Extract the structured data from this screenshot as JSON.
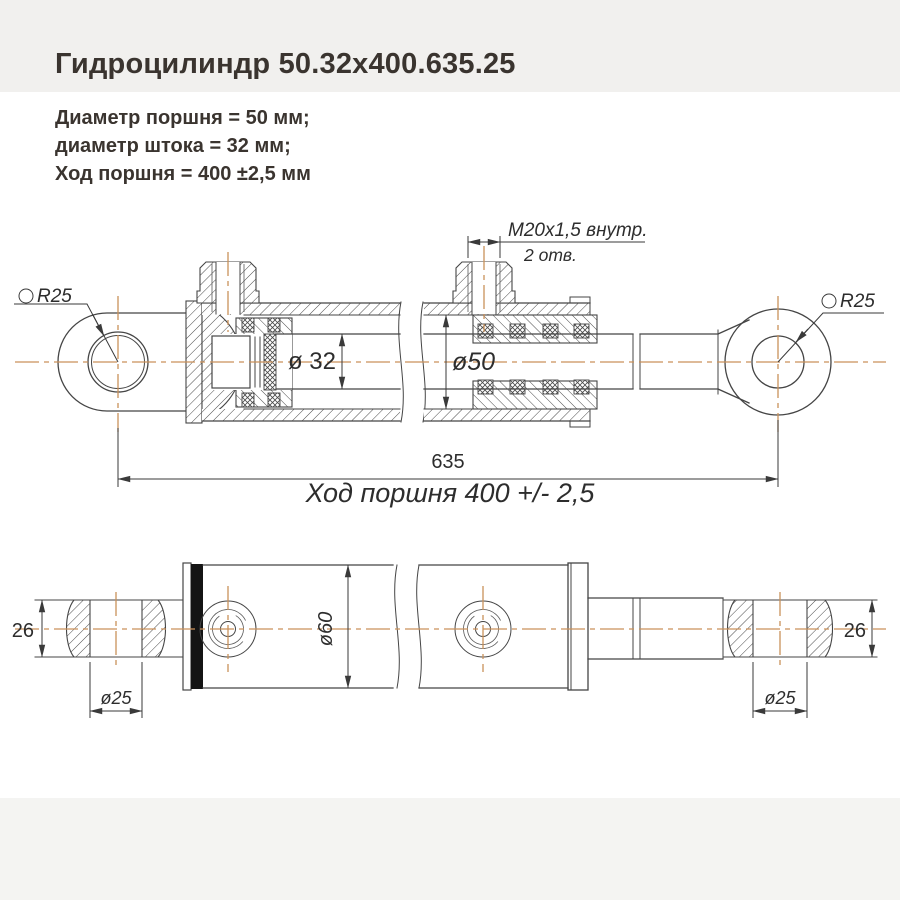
{
  "title": "Гидроцилиндр 50.32х400.635.25",
  "specs": {
    "piston_diameter": "Диаметр поршня = 50 мм;",
    "rod_diameter": "диаметр штока = 32 мм;",
    "stroke": "Ход поршня = 400 ±2,5 мм"
  },
  "top_view": {
    "port_thread": "M20x1,5 внутр.",
    "port_count": "2 отв.",
    "rod_diameter": "ø 32",
    "bore_diameter": "ø50",
    "eye_radius_left": "R25",
    "eye_radius_right": "R25",
    "overall_length": "635",
    "stroke_caption": "Ход поршня 400 +/- 2,5"
  },
  "bottom_view": {
    "eye_width_left": "26",
    "eye_width_right": "26",
    "eye_hole_left": "ø25",
    "eye_hole_right": "ø25",
    "tube_diameter": "ø60"
  },
  "colors": {
    "centerline": "#c9915a",
    "drawing_line": "#454545",
    "header_band": "#f1f0ee",
    "footer_band": "#f4f4f2",
    "end_cap_band": "#141414",
    "title_text": "#3a342f"
  }
}
